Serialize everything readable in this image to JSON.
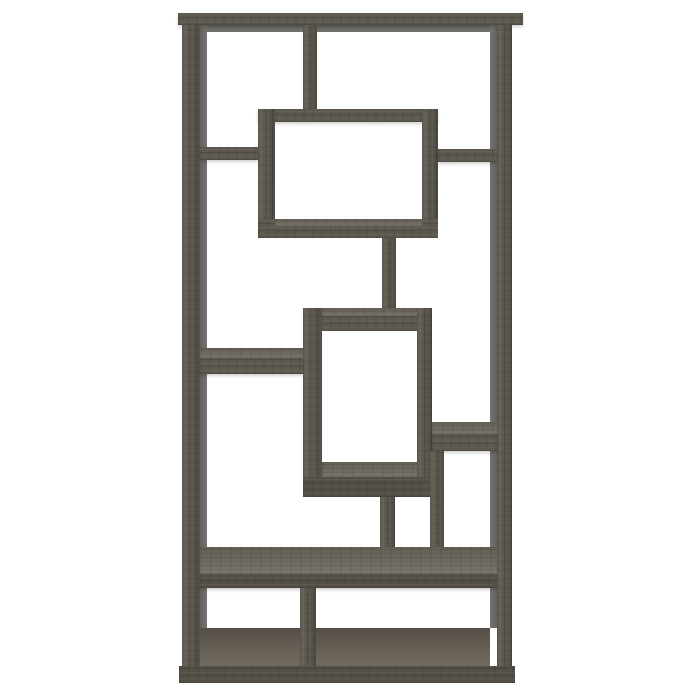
{
  "image": {
    "description": "Front view of a 10-shelf geometric bookcase in a weathered grey wood finish, photographed on a plain white background. Interlocking rectangular frames form two protruding display boxes, staggered open shelves and a plinth base.",
    "subject": "geometric bookcase",
    "finish": "weathered grey wood",
    "background": "white studio backdrop"
  },
  "colors": {
    "background": "#ffffff",
    "wood_front": "#5e594f",
    "wood_front_dark": "#555047",
    "wood_top": "#6f6a5f",
    "wood_grain_dark": "#48443d",
    "shadow_face": "#6f6e6a",
    "base_dark": "#524e46"
  }
}
